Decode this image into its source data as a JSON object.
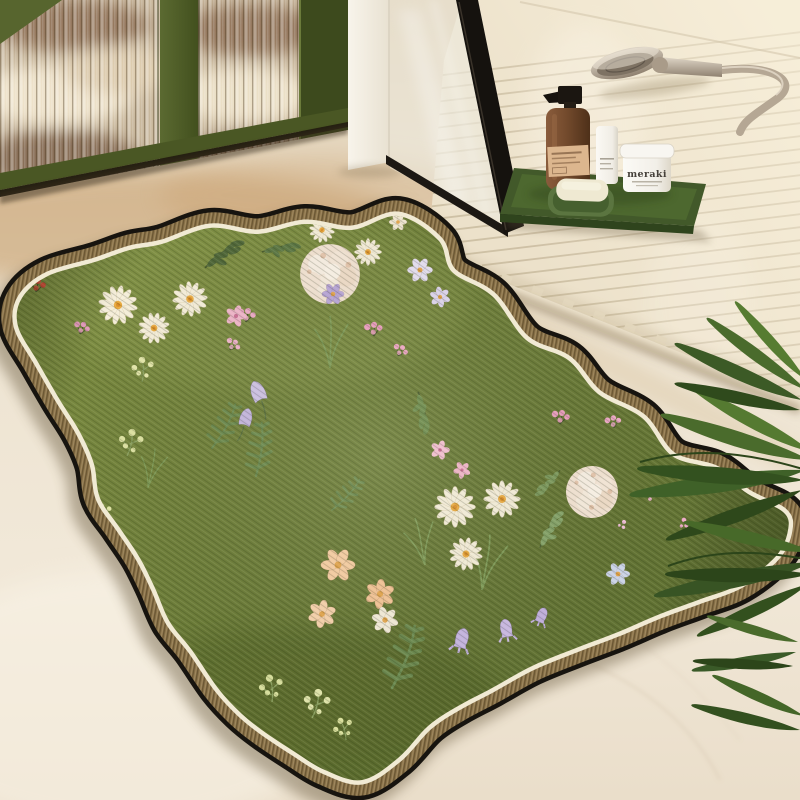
{
  "scene": {
    "description": "Product photo of a wavy-edged green floral bath mat lying on a beige stone floor in a bathroom, beside an olive-green cabinet with fluted glass doors, a black-framed glass shower screen, a wooden slat shower platform with a handheld shower head, a green amenity tray with toiletries, and arching palm fronds",
    "objects": [
      "cabinet",
      "wall-pillar",
      "shower-screen",
      "slat-platform",
      "shower-head",
      "amenity-tray",
      "soap-dispenser",
      "cosmetic-tube",
      "cream-jar",
      "soap-dish",
      "soap-bar",
      "floral-rug",
      "palm-plant",
      "stone-floor"
    ]
  },
  "products": {
    "jar_label": "meraki"
  },
  "colors": {
    "rug_green_light": "#7a8a40",
    "rug_green_dark": "#5d6e31",
    "border_brown": "#8a7248",
    "border_cream": "#f1ead4",
    "edge_black": "#17140f",
    "tray_green": "#4d682f",
    "cabinet_green": "#57652e",
    "bottle_amber": "#744b2d",
    "wood_slat": "#ece1ca",
    "floor_beige": "#ede3d0",
    "plant_green": "#3c5a24"
  },
  "rug": {
    "outline": [
      [
        162,
        244
      ],
      [
        210,
        228
      ],
      [
        258,
        234
      ],
      [
        305,
        224
      ],
      [
        352,
        230
      ],
      [
        398,
        216
      ],
      [
        438,
        240
      ],
      [
        452,
        272
      ],
      [
        492,
        296
      ],
      [
        526,
        340
      ],
      [
        568,
        360
      ],
      [
        598,
        394
      ],
      [
        642,
        418
      ],
      [
        672,
        456
      ],
      [
        716,
        470
      ],
      [
        748,
        494
      ],
      [
        783,
        512
      ],
      [
        788,
        530
      ],
      [
        776,
        556
      ],
      [
        740,
        584
      ],
      [
        698,
        600
      ],
      [
        660,
        614
      ],
      [
        618,
        632
      ],
      [
        576,
        648
      ],
      [
        532,
        666
      ],
      [
        492,
        688
      ],
      [
        458,
        706
      ],
      [
        428,
        726
      ],
      [
        398,
        758
      ],
      [
        362,
        780
      ],
      [
        325,
        770
      ],
      [
        295,
        752
      ],
      [
        262,
        730
      ],
      [
        240,
        712
      ],
      [
        218,
        688
      ],
      [
        192,
        650
      ],
      [
        170,
        622
      ],
      [
        155,
        588
      ],
      [
        140,
        558
      ],
      [
        120,
        528
      ],
      [
        100,
        498
      ],
      [
        94,
        464
      ],
      [
        80,
        432
      ],
      [
        60,
        400
      ],
      [
        38,
        362
      ],
      [
        18,
        326
      ],
      [
        22,
        298
      ],
      [
        48,
        276
      ],
      [
        95,
        262
      ],
      [
        130,
        250
      ]
    ]
  },
  "rug_pattern": [
    {
      "m": "branch",
      "x": 205,
      "y": 268,
      "s": 1.2,
      "r": -18,
      "c": "#51683a"
    },
    {
      "m": "branch",
      "x": 262,
      "y": 252,
      "s": 1.0,
      "r": 8,
      "c": "#5d7845"
    },
    {
      "m": "branch",
      "x": 418,
      "y": 392,
      "s": 1.1,
      "r": 96,
      "c": "#6f8d4f"
    },
    {
      "m": "branch",
      "x": 540,
      "y": 548,
      "s": 1.1,
      "r": -42,
      "c": "#85a369"
    },
    {
      "m": "branch",
      "x": 560,
      "y": 470,
      "s": 0.9,
      "r": 150,
      "c": "#7d9a5e"
    },
    {
      "m": "fern",
      "x": 212,
      "y": 448,
      "s": 1.2,
      "r": 14
    },
    {
      "m": "fern",
      "x": 256,
      "y": 476,
      "s": 1.3,
      "r": -8
    },
    {
      "m": "fern",
      "x": 392,
      "y": 688,
      "s": 1.6,
      "r": 6
    },
    {
      "m": "fern",
      "x": 332,
      "y": 510,
      "s": 1.0,
      "r": 28
    },
    {
      "m": "grass",
      "x": 330,
      "y": 368,
      "s": 1.3,
      "r": 0
    },
    {
      "m": "grass",
      "x": 425,
      "y": 565,
      "s": 1.2,
      "r": -12
    },
    {
      "m": "grass",
      "x": 482,
      "y": 590,
      "s": 1.4,
      "r": 8
    },
    {
      "m": "grass",
      "x": 148,
      "y": 488,
      "s": 1.0,
      "r": 10
    },
    {
      "m": "sprig",
      "x": 142,
      "y": 382,
      "s": 1.1,
      "r": 0,
      "c": "#e3e6aa"
    },
    {
      "m": "sprig",
      "x": 127,
      "y": 456,
      "s": 1.2,
      "r": 12,
      "c": "#dde2a2"
    },
    {
      "m": "sprig",
      "x": 104,
      "y": 524,
      "s": 0.9,
      "r": -8,
      "c": "#e0e4a6"
    },
    {
      "m": "sprig",
      "x": 272,
      "y": 702,
      "s": 1.2,
      "r": -6,
      "c": "#d9e09e"
    },
    {
      "m": "sprig",
      "x": 312,
      "y": 718,
      "s": 1.3,
      "r": 14,
      "c": "#e2e6ac"
    },
    {
      "m": "sprig",
      "x": 346,
      "y": 740,
      "s": 1.0,
      "r": -16,
      "c": "#dce29f"
    },
    {
      "m": "berry",
      "x": 36,
      "y": 292,
      "s": 1,
      "r": 0,
      "c": "#cf4b38"
    },
    {
      "m": "berry",
      "x": 80,
      "y": 334,
      "s": 0.9,
      "r": 10,
      "c": "#e79cbe"
    },
    {
      "m": "berry",
      "x": 246,
      "y": 322,
      "s": 1.0,
      "r": 0,
      "c": "#eda9c6"
    },
    {
      "m": "berry",
      "x": 230,
      "y": 350,
      "s": 0.85,
      "r": 24,
      "c": "#f0b3cc"
    },
    {
      "m": "berry",
      "x": 374,
      "y": 336,
      "s": 1.0,
      "r": -10,
      "c": "#ec9fc0"
    },
    {
      "m": "berry",
      "x": 398,
      "y": 356,
      "s": 0.85,
      "r": 18,
      "c": "#f0a9c6"
    },
    {
      "m": "berry",
      "x": 560,
      "y": 424,
      "s": 1.0,
      "r": 0,
      "c": "#ec9fc0"
    },
    {
      "m": "berry",
      "x": 614,
      "y": 428,
      "s": 0.9,
      "r": -14,
      "c": "#efaac8"
    },
    {
      "m": "dots",
      "x": 150,
      "y": 612,
      "s": 0.9,
      "r": 0,
      "c": "#f0b6ce"
    },
    {
      "m": "dots",
      "x": 122,
      "y": 562,
      "s": 0.8,
      "r": 30,
      "c": "#eeb0c8"
    },
    {
      "m": "dots",
      "x": 648,
      "y": 492,
      "s": 1.0,
      "r": 0,
      "c": "#f2b8d2"
    },
    {
      "m": "dots",
      "x": 684,
      "y": 520,
      "s": 0.9,
      "r": 40,
      "c": "#edaac9"
    },
    {
      "m": "dots",
      "x": 624,
      "y": 522,
      "s": 0.8,
      "r": 70,
      "c": "#f0c0d6"
    },
    {
      "m": "dots",
      "x": 210,
      "y": 688,
      "s": 0.8,
      "r": 0,
      "c": "#efb5cd"
    },
    {
      "m": "puff",
      "x": 330,
      "y": 274,
      "s": 1.15,
      "r": 0
    },
    {
      "m": "puff",
      "x": 592,
      "y": 492,
      "s": 1.0,
      "r": 25
    },
    {
      "m": "daisy",
      "x": 118,
      "y": 305,
      "s": 1.0,
      "r": 10
    },
    {
      "m": "daisy",
      "x": 154,
      "y": 328,
      "s": 0.8,
      "r": -15
    },
    {
      "m": "daisy",
      "x": 190,
      "y": 299,
      "s": 0.9,
      "r": 25
    },
    {
      "m": "daisy",
      "x": 368,
      "y": 252,
      "s": 0.7,
      "r": 0
    },
    {
      "m": "daisy",
      "x": 322,
      "y": 230,
      "s": 0.65,
      "r": 40
    },
    {
      "m": "daisy",
      "x": 455,
      "y": 507,
      "s": 1.05,
      "r": 0
    },
    {
      "m": "daisy",
      "x": 502,
      "y": 499,
      "s": 0.95,
      "r": 30
    },
    {
      "m": "daisy",
      "x": 466,
      "y": 554,
      "s": 0.85,
      "r": -20
    },
    {
      "m": "flower6",
      "x": 420,
      "y": 270,
      "s": 0.85,
      "r": 0,
      "c": "#e6e0f2"
    },
    {
      "m": "flower6",
      "x": 440,
      "y": 297,
      "s": 0.7,
      "r": 20,
      "c": "#ded6ee"
    },
    {
      "m": "flower6",
      "x": 333,
      "y": 294,
      "s": 0.75,
      "r": 0,
      "c": "#b9a6d8"
    },
    {
      "m": "flower6",
      "x": 398,
      "y": 222,
      "s": 0.6,
      "r": 0,
      "c": "#f2e9d4"
    },
    {
      "m": "flower6",
      "x": 338,
      "y": 565,
      "s": 1.15,
      "r": 0,
      "c": "#f6cda2"
    },
    {
      "m": "flower6",
      "x": 380,
      "y": 594,
      "s": 1.0,
      "r": 35,
      "c": "#f4c496"
    },
    {
      "m": "flower6",
      "x": 322,
      "y": 614,
      "s": 0.95,
      "r": -20,
      "c": "#f7d2ac"
    },
    {
      "m": "flower6",
      "x": 385,
      "y": 620,
      "s": 0.9,
      "r": 15,
      "c": "#f4ecda"
    },
    {
      "m": "flower6",
      "x": 618,
      "y": 574,
      "s": 0.8,
      "r": 0,
      "c": "#cdd5ea"
    },
    {
      "m": "pink5",
      "x": 236,
      "y": 316,
      "s": 1.0,
      "r": 0,
      "c": "#f0b6ca"
    },
    {
      "m": "pink5",
      "x": 440,
      "y": 450,
      "s": 0.9,
      "r": 0,
      "c": "#f3bed0"
    },
    {
      "m": "pink5",
      "x": 462,
      "y": 470,
      "s": 0.8,
      "r": 25,
      "c": "#f0b4c8"
    },
    {
      "m": "tulip",
      "x": 258,
      "y": 392,
      "s": 1.05,
      "r": -22,
      "c": "#cfc2e6"
    },
    {
      "m": "tulip",
      "x": 246,
      "y": 418,
      "s": 0.9,
      "r": 14,
      "c": "#c6b7e0"
    },
    {
      "m": "bell",
      "x": 462,
      "y": 638,
      "s": 1.1,
      "r": 14,
      "c": "#c7b6e2"
    },
    {
      "m": "bell",
      "x": 506,
      "y": 628,
      "s": 1.0,
      "r": -10,
      "c": "#cbbae4"
    },
    {
      "m": "bell",
      "x": 542,
      "y": 615,
      "s": 0.85,
      "r": 22,
      "c": "#c2b0de"
    }
  ],
  "plant_fronds": [
    {
      "m": "leaf",
      "g": "plant",
      "x": 806,
      "y": 470,
      "s": 1.6,
      "r": 172,
      "c": "#3f6128"
    },
    {
      "m": "leaf",
      "g": "plant",
      "x": 804,
      "y": 480,
      "s": 1.5,
      "r": 184,
      "c": "#33511f"
    },
    {
      "m": "leaf",
      "g": "plant",
      "x": 810,
      "y": 460,
      "s": 1.4,
      "r": 197,
      "c": "#4a6b2c"
    },
    {
      "m": "leaf",
      "g": "plant",
      "x": 802,
      "y": 490,
      "s": 1.3,
      "r": 160,
      "c": "#2e481b"
    },
    {
      "m": "leaf",
      "g": "plant",
      "x": 812,
      "y": 452,
      "s": 1.2,
      "r": 208,
      "c": "#557a31"
    },
    {
      "m": "leaf",
      "g": "plant",
      "x": 812,
      "y": 562,
      "s": 1.45,
      "r": 168,
      "c": "#385424"
    },
    {
      "m": "leaf",
      "g": "plant",
      "x": 810,
      "y": 574,
      "s": 1.3,
      "r": 180,
      "c": "#2c451a"
    },
    {
      "m": "leaf",
      "g": "plant",
      "x": 814,
      "y": 552,
      "s": 1.2,
      "r": 193,
      "c": "#476929"
    },
    {
      "m": "leaf",
      "g": "plant",
      "x": 808,
      "y": 584,
      "s": 1.1,
      "r": 155,
      "c": "#33501e"
    },
    {
      "m": "leaf",
      "g": "plant",
      "x": 802,
      "y": 400,
      "s": 1.25,
      "r": 204,
      "c": "#3c5a26"
    },
    {
      "m": "leaf",
      "g": "plant",
      "x": 806,
      "y": 390,
      "s": 1.1,
      "r": 216,
      "c": "#4a6b2c"
    },
    {
      "m": "leaf",
      "g": "plant",
      "x": 800,
      "y": 410,
      "s": 1.15,
      "r": 192,
      "c": "#2f4a1c"
    },
    {
      "m": "leaf",
      "g": "plant",
      "x": 806,
      "y": 380,
      "s": 0.95,
      "r": 228,
      "c": "#567c31"
    },
    {
      "m": "leaf",
      "g": "plant",
      "x": 796,
      "y": 652,
      "s": 0.95,
      "r": 170,
      "c": "#3a5a28"
    },
    {
      "m": "leaf",
      "g": "plant",
      "x": 793,
      "y": 666,
      "s": 0.9,
      "r": 183,
      "c": "#2c451a"
    },
    {
      "m": "leaf",
      "g": "plant",
      "x": 798,
      "y": 642,
      "s": 0.85,
      "r": 196,
      "c": "#4a6b2c"
    },
    {
      "m": "leaf",
      "g": "plant",
      "x": 800,
      "y": 730,
      "s": 1.0,
      "r": 193,
      "c": "#33501f"
    },
    {
      "m": "leaf",
      "g": "plant",
      "x": 804,
      "y": 716,
      "s": 0.9,
      "r": 204,
      "c": "#446628"
    }
  ]
}
